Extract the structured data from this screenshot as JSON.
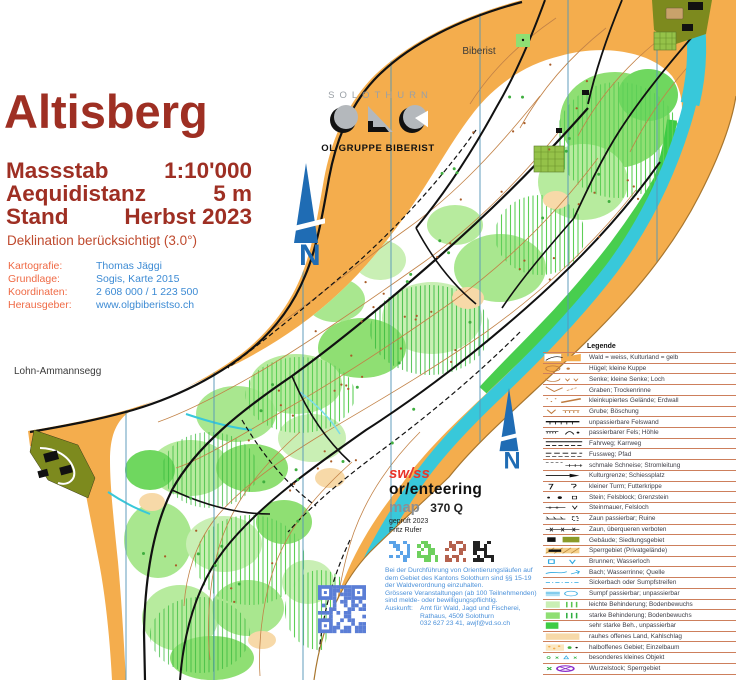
{
  "palette": {
    "map_yellow": "#f4ad4d",
    "forest_white": "#ffffff",
    "water_cyan": "#38c8da",
    "green_light": "#c9efb4",
    "green_medium": "#8fdf73",
    "green_full": "#3ecb44",
    "olive_settlement": "#7d8a1e",
    "contour_brown": "#c28247",
    "title_red": "#9e2f23",
    "label_orange": "#ef6a45",
    "value_blue": "#3d8bd4",
    "north_blue": "#1f6cb4",
    "legend_line": "#cd7f5c",
    "qr_blue": "#5b7ed6",
    "brand_red": "#e8352a"
  },
  "title_block": {
    "title": "Altisberg",
    "rows": [
      {
        "label": "Massstab",
        "value": "1:10'000"
      },
      {
        "label": "Aequidistanz",
        "value": "5 m"
      },
      {
        "label": "Stand",
        "value": "Herbst 2023"
      }
    ],
    "declination": "Deklination berücksichtigt (3.0°)"
  },
  "metadata": {
    "rows": [
      {
        "label": "Kartografie:",
        "value": "Thomas Jäggi"
      },
      {
        "label": "Grundlage:",
        "value": "Sogis, Karte 2015"
      },
      {
        "label": "Koordinaten:",
        "value": "2 608 000 / 1 223 500"
      },
      {
        "label": "Herausgeber:",
        "value": "www.olgbiberistso.ch"
      }
    ]
  },
  "club_logo": {
    "region": "SOLOTHURN",
    "club": "OL GRUPPE BIBERIST"
  },
  "map_labels": {
    "town_ne": "Biberist",
    "town_sw": "Lohn-Ammannsegg",
    "north": "N"
  },
  "certification": {
    "brand_line1": "sw/ss",
    "brand_line2": "or/enteering",
    "map_word": "map",
    "map_number": "370 Q",
    "checked": "geprüft 2023",
    "checker": "Fritz Rufer"
  },
  "notice": {
    "lines": [
      "Bei der Durchführung von Orientierungsläufen auf",
      "dem Gebiet des Kantons Solothurn sind §§ 15-19",
      "der Waldverordnung einzuhalten.",
      "Grössere Veranstaltungen (ab 100 Teilnehmenden)",
      "sind melde- oder bewilligungspflichtig."
    ],
    "contact_label": "Auskunft:",
    "contact_lines": [
      "Amt für Wald, Jagd und Fischerei,",
      "Rathaus, 4509 Solothurn",
      "032 627 23 41, awjf@vd.so.ch"
    ]
  },
  "legend": {
    "title": "Legende",
    "items": [
      {
        "icon": "forest-field-swatch",
        "label": "Wald = weiss, Kulturland = gelb"
      },
      {
        "icon": "hill-knoll",
        "label": "Hügel; kleine Kuppe"
      },
      {
        "icon": "depression-pit",
        "label": "Senke; kleine Senke; Loch"
      },
      {
        "icon": "ditch-dry-gully",
        "label": "Graben; Trockenrinne"
      },
      {
        "icon": "broken-ground-earthwall",
        "label": "kleinkupiertes Gelände; Erdwall"
      },
      {
        "icon": "gravel-pit-bank",
        "label": "Grube; Böschung"
      },
      {
        "icon": "impassable-cliff",
        "label": "unpassierbare Felswand"
      },
      {
        "icon": "passable-rock-cave",
        "label": "passierbarer Fels; Höhle"
      },
      {
        "icon": "vehicle-track-cart-track",
        "label": "Fahrweg; Karrweg"
      },
      {
        "icon": "footpath-trail",
        "label": "Fussweg; Pfad"
      },
      {
        "icon": "narrow-ride-power-line",
        "label": "schmale Schneise; Stromleitung"
      },
      {
        "icon": "cultivation-boundary-shooting-range",
        "label": "Kulturgrenze; Schiessplatz"
      },
      {
        "icon": "small-tower-feed-rack",
        "label": "kleiner Turm; Futterkrippe"
      },
      {
        "icon": "stone-boulder-boundary-stone",
        "label": "Stein; Felsblock; Grenzstein"
      },
      {
        "icon": "stone-wall-rock-hole",
        "label": "Steinmauer, Felsloch"
      },
      {
        "icon": "passable-fence-ruin",
        "label": "Zaun passierbar; Ruine"
      },
      {
        "icon": "forbidden-fence",
        "label": "Zaun, überqueren verboten"
      },
      {
        "icon": "building-settlement",
        "label": "Gebäude; Siedlungsgebiet"
      },
      {
        "icon": "private-restricted-area",
        "label": "Sperrgebiet (Privatgelände)"
      },
      {
        "icon": "well-waterhole",
        "label": "Brunnen; Wasserloch"
      },
      {
        "icon": "stream-gully-spring",
        "label": "Bach; Wasserrinne; Quelle"
      },
      {
        "icon": "seepage-marsh-strip",
        "label": "Sickerbach oder Sumpfstreifen"
      },
      {
        "icon": "marsh",
        "label": "Sumpf passierbar; unpassierbar"
      },
      {
        "icon": "light-undergrowth",
        "label": "leichte Behinderung; Bodenbewuchs"
      },
      {
        "icon": "strong-undergrowth",
        "label": "starke Behinderung; Bodenbewuchs"
      },
      {
        "icon": "very-strong-undergrowth",
        "label": "sehr starke Beh., unpassierbar"
      },
      {
        "icon": "rough-open-land",
        "label": "rauhes offenes Land, Kahlschlag"
      },
      {
        "icon": "semi-open-land-single-tree",
        "label": "halboffenes Gebiet; Einzelbaum"
      },
      {
        "icon": "special-small-object",
        "label": "besonderes kleines Objekt"
      },
      {
        "icon": "rootstock-out-of-bounds",
        "label": "Wurzelstock; Sperrgebiet"
      }
    ]
  }
}
